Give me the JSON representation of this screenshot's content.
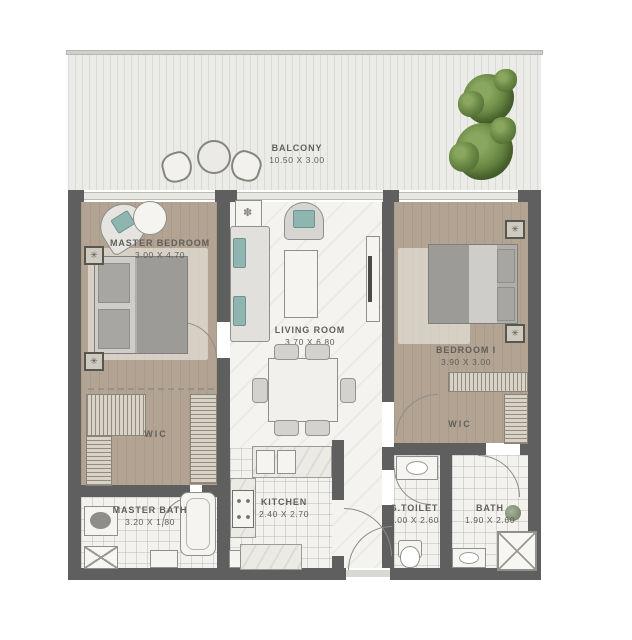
{
  "plan_title": "2-bedroom apartment floor plan",
  "balcony": {
    "name": "BALCONY",
    "dims": "10.50 X 3.00"
  },
  "rooms": {
    "master_bedroom": {
      "name": "MASTER BEDROOM",
      "dims": "3.00 X 4.70"
    },
    "living_room": {
      "name": "LIVING ROOM",
      "dims": "3.70 X 6.80"
    },
    "bedroom_1": {
      "name": "BEDROOM I",
      "dims": "3.90 X 3.00"
    },
    "wic_master": {
      "name": "WIC"
    },
    "wic_bedroom1": {
      "name": "WIC"
    },
    "master_bath": {
      "name": "MASTER BATH",
      "dims": "3.20 X 1.80"
    },
    "kitchen": {
      "name": "KITCHEN",
      "dims": "2.40 X 2.70"
    },
    "guest_toilet": {
      "name": "G.TOILET",
      "dims": "1.00 X 2.60"
    },
    "bath": {
      "name": "BATH",
      "dims": "1.90 X 2.60"
    }
  },
  "icons": {
    "ac_unit": "✳",
    "flower": "✽"
  },
  "colors": {
    "wall": "#5e5f5e",
    "wood": "#b2a392",
    "marble": "#f4f3f0",
    "label": "#5f5f5b",
    "accent_teal": "#8fb5b1",
    "tree_green": "#5c7c3a"
  }
}
